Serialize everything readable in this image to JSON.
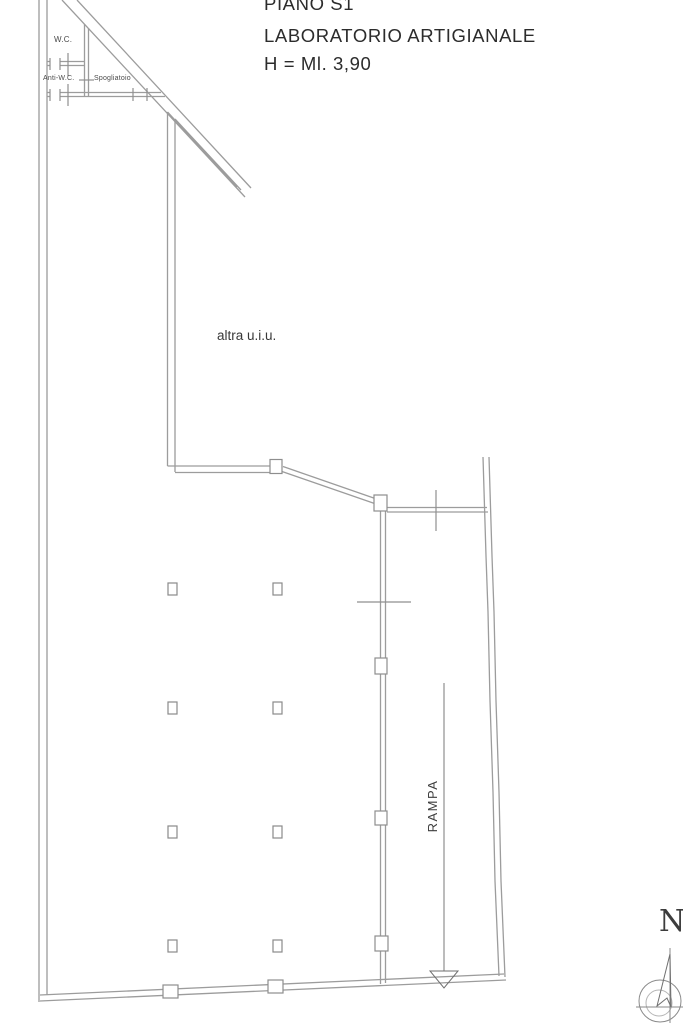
{
  "header": {
    "line1": "PIANO S1",
    "line2": "LABORATORIO ARTIGIANALE",
    "line3": "H = Ml. 3,90"
  },
  "rooms": {
    "wc": "W.C.",
    "anti_wc": "Anti-W.C.",
    "spogliatoio": "Spogliatoio",
    "other_unit": "altra u.i.u.",
    "ramp": "RAMPA"
  },
  "compass": {
    "north": "N"
  },
  "colors": {
    "background": "#ffffff",
    "wall_line": "#9c9c9c",
    "text": "#3a3a3a"
  }
}
